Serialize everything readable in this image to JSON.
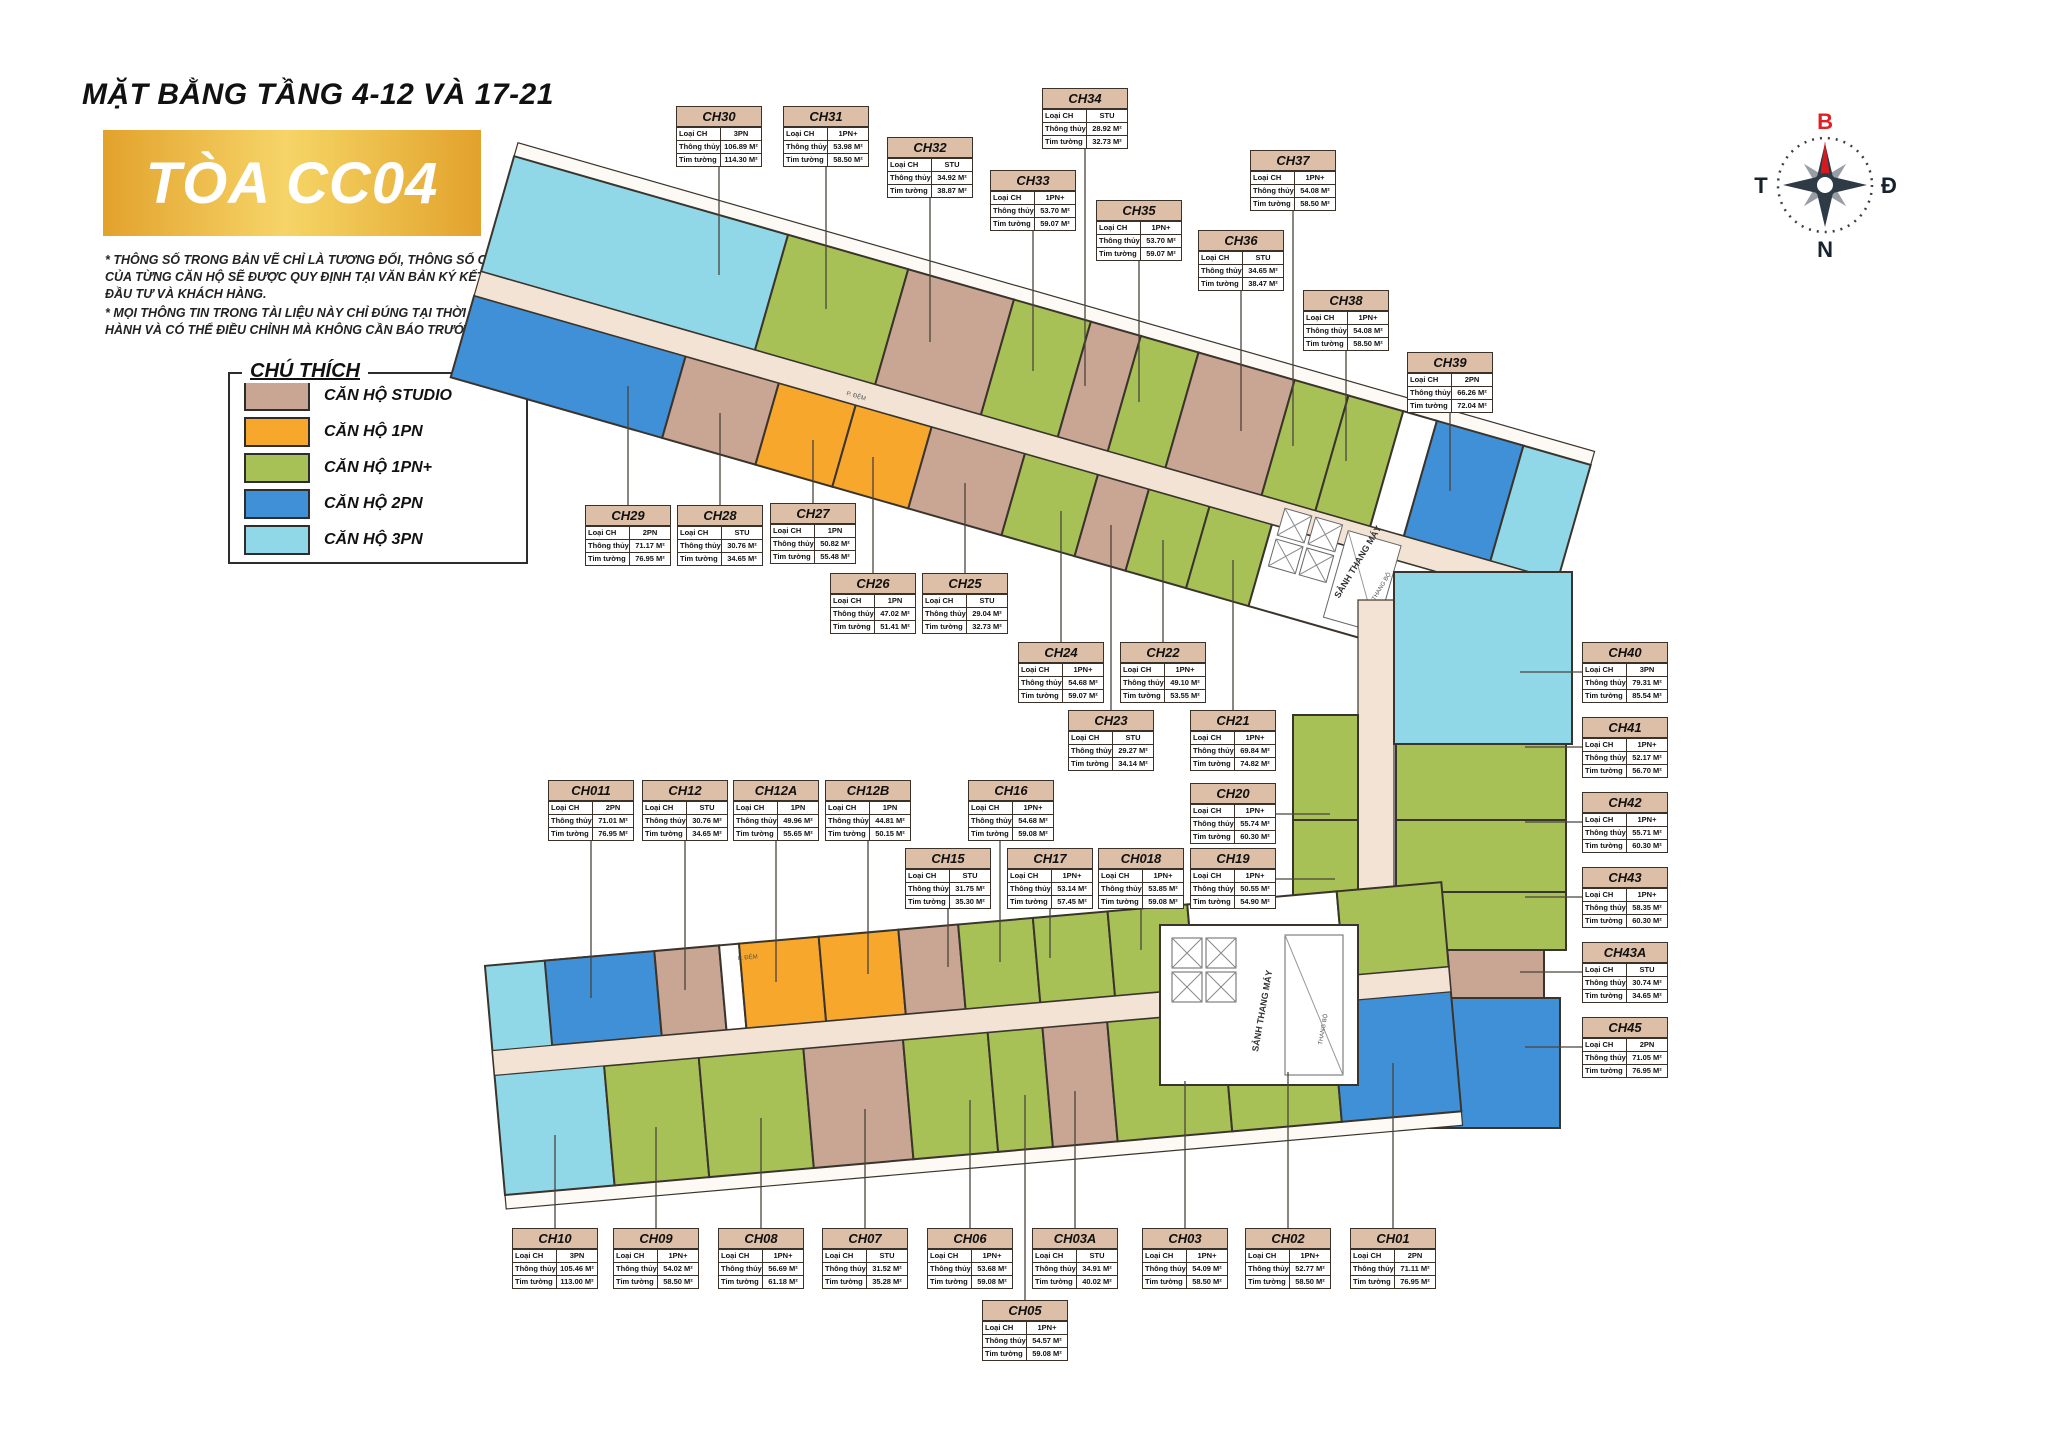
{
  "header": {
    "title": "MẶT BẰNG TẦNG 4-12 VÀ 17-21",
    "banner": "TÒA CC04",
    "disclaimer1": "* THÔNG SỐ TRONG BẢN VẼ CHỈ LÀ TƯƠNG ĐỐI, THÔNG SỐ CHÍNH THỨC CỦA TỪNG CĂN HỘ SẼ ĐƯỢC QUY ĐỊNH TẠI VĂN BẢN KÝ KẾT GIỮA CHỦ ĐẦU TƯ VÀ KHÁCH HÀNG.",
    "disclaimer2": "* MỌI THÔNG TIN TRONG TÀI LIỆU NÀY CHỈ ĐÚNG TẠI THỜI ĐIỂM PHÁT HÀNH VÀ CÓ THỂ ĐIỀU CHỈNH MÀ KHÔNG CẦN BÁO TRƯỚC."
  },
  "legend": {
    "title": "CHÚ THÍCH",
    "items": [
      {
        "key": "STU",
        "label": "CĂN HỘ STUDIO",
        "color": "#c9a593"
      },
      {
        "key": "1PN",
        "label": "CĂN HỘ 1PN",
        "color": "#f7a72b"
      },
      {
        "key": "1PN+",
        "label": "CĂN HỘ 1PN+",
        "color": "#a8c157"
      },
      {
        "key": "2PN",
        "label": "CĂN HỘ 2PN",
        "color": "#4090d8"
      },
      {
        "key": "3PN",
        "label": "CĂN HỘ 3PN",
        "color": "#90d8e8"
      }
    ]
  },
  "compass": {
    "north": "B",
    "east": "Đ",
    "south": "N",
    "west": "T",
    "north_color": "#e21d23"
  },
  "unit_fields": {
    "type": "Loại CH",
    "net": "Thông thủy",
    "gross": "Tim tường"
  },
  "plan_annotations": {
    "lobby": "SẢNH THANG MÁY",
    "stairs": "THANG BỘ",
    "buffer": "P. ĐỆM"
  },
  "units": [
    {
      "id": "CH30",
      "type": "3PN",
      "net": "106.89 M²",
      "gross": "114.30 M²"
    },
    {
      "id": "CH31",
      "type": "1PN+",
      "net": "53.98 M²",
      "gross": "58.50 M²"
    },
    {
      "id": "CH32",
      "type": "STU",
      "net": "34.92 M²",
      "gross": "38.87 M²"
    },
    {
      "id": "CH33",
      "type": "1PN+",
      "net": "53.70 M²",
      "gross": "59.07 M²"
    },
    {
      "id": "CH34",
      "type": "STU",
      "net": "28.92 M²",
      "gross": "32.73 M²"
    },
    {
      "id": "CH35",
      "type": "1PN+",
      "net": "53.70 M²",
      "gross": "59.07 M²"
    },
    {
      "id": "CH36",
      "type": "STU",
      "net": "34.65 M²",
      "gross": "38.47 M²"
    },
    {
      "id": "CH37",
      "type": "1PN+",
      "net": "54.08 M²",
      "gross": "58.50 M²"
    },
    {
      "id": "CH38",
      "type": "1PN+",
      "net": "54.08 M²",
      "gross": "58.50 M²"
    },
    {
      "id": "CH39",
      "type": "2PN",
      "net": "66.26 M²",
      "gross": "72.04 M²"
    },
    {
      "id": "CH29",
      "type": "2PN",
      "net": "71.17 M²",
      "gross": "76.95 M²"
    },
    {
      "id": "CH28",
      "type": "STU",
      "net": "30.76 M²",
      "gross": "34.65 M²"
    },
    {
      "id": "CH27",
      "type": "1PN",
      "net": "50.82 M²",
      "gross": "55.48 M²"
    },
    {
      "id": "CH26",
      "type": "1PN",
      "net": "47.02 M²",
      "gross": "51.41 M²"
    },
    {
      "id": "CH25",
      "type": "STU",
      "net": "29.04 M²",
      "gross": "32.73 M²"
    },
    {
      "id": "CH24",
      "type": "1PN+",
      "net": "54.68 M²",
      "gross": "59.07 M²"
    },
    {
      "id": "CH23",
      "type": "STU",
      "net": "29.27 M²",
      "gross": "34.14 M²"
    },
    {
      "id": "CH22",
      "type": "1PN+",
      "net": "49.10 M²",
      "gross": "53.55 M²"
    },
    {
      "id": "CH21",
      "type": "1PN+",
      "net": "69.84 M²",
      "gross": "74.82 M²"
    },
    {
      "id": "CH20",
      "type": "1PN+",
      "net": "55.74 M²",
      "gross": "60.30 M²"
    },
    {
      "id": "CH19",
      "type": "1PN+",
      "net": "50.55 M²",
      "gross": "54.90 M²"
    },
    {
      "id": "CH018",
      "type": "1PN+",
      "net": "53.85 M²",
      "gross": "59.08 M²"
    },
    {
      "id": "CH17",
      "type": "1PN+",
      "net": "53.14 M²",
      "gross": "57.45 M²"
    },
    {
      "id": "CH16",
      "type": "1PN+",
      "net": "54.68 M²",
      "gross": "59.08 M²"
    },
    {
      "id": "CH15",
      "type": "STU",
      "net": "31.75 M²",
      "gross": "35.30 M²"
    },
    {
      "id": "CH12B",
      "type": "1PN",
      "net": "44.81 M²",
      "gross": "50.15 M²"
    },
    {
      "id": "CH12A",
      "type": "1PN",
      "net": "49.96 M²",
      "gross": "55.65 M²"
    },
    {
      "id": "CH12",
      "type": "STU",
      "net": "30.76 M²",
      "gross": "34.65 M²"
    },
    {
      "id": "CH011",
      "type": "2PN",
      "net": "71.01 M²",
      "gross": "76.95 M²"
    },
    {
      "id": "CH10",
      "type": "3PN",
      "net": "105.46 M²",
      "gross": "113.00 M²"
    },
    {
      "id": "CH09",
      "type": "1PN+",
      "net": "54.02 M²",
      "gross": "58.50 M²"
    },
    {
      "id": "CH08",
      "type": "1PN+",
      "net": "56.69 M²",
      "gross": "61.18 M²"
    },
    {
      "id": "CH07",
      "type": "STU",
      "net": "31.52 M²",
      "gross": "35.28 M²"
    },
    {
      "id": "CH06",
      "type": "1PN+",
      "net": "53.68 M²",
      "gross": "59.08 M²"
    },
    {
      "id": "CH05",
      "type": "1PN+",
      "net": "54.57 M²",
      "gross": "59.08 M²"
    },
    {
      "id": "CH03A",
      "type": "STU",
      "net": "34.91 M²",
      "gross": "40.02 M²"
    },
    {
      "id": "CH03",
      "type": "1PN+",
      "net": "54.09 M²",
      "gross": "58.50 M²"
    },
    {
      "id": "CH02",
      "type": "1PN+",
      "net": "52.77 M²",
      "gross": "58.50 M²"
    },
    {
      "id": "CH01",
      "type": "2PN",
      "net": "71.11 M²",
      "gross": "76.95 M²"
    },
    {
      "id": "CH40",
      "type": "3PN",
      "net": "79.31 M²",
      "gross": "85.54 M²"
    },
    {
      "id": "CH41",
      "type": "1PN+",
      "net": "52.17 M²",
      "gross": "56.70 M²"
    },
    {
      "id": "CH42",
      "type": "1PN+",
      "net": "55.71 M²",
      "gross": "60.30 M²"
    },
    {
      "id": "CH43",
      "type": "1PN+",
      "net": "58.35 M²",
      "gross": "60.30 M²"
    },
    {
      "id": "CH43A",
      "type": "STU",
      "net": "30.74 M²",
      "gross": "34.65 M²"
    },
    {
      "id": "CH45",
      "type": "2PN",
      "net": "71.05 M²",
      "gross": "76.95 M²"
    }
  ]
}
